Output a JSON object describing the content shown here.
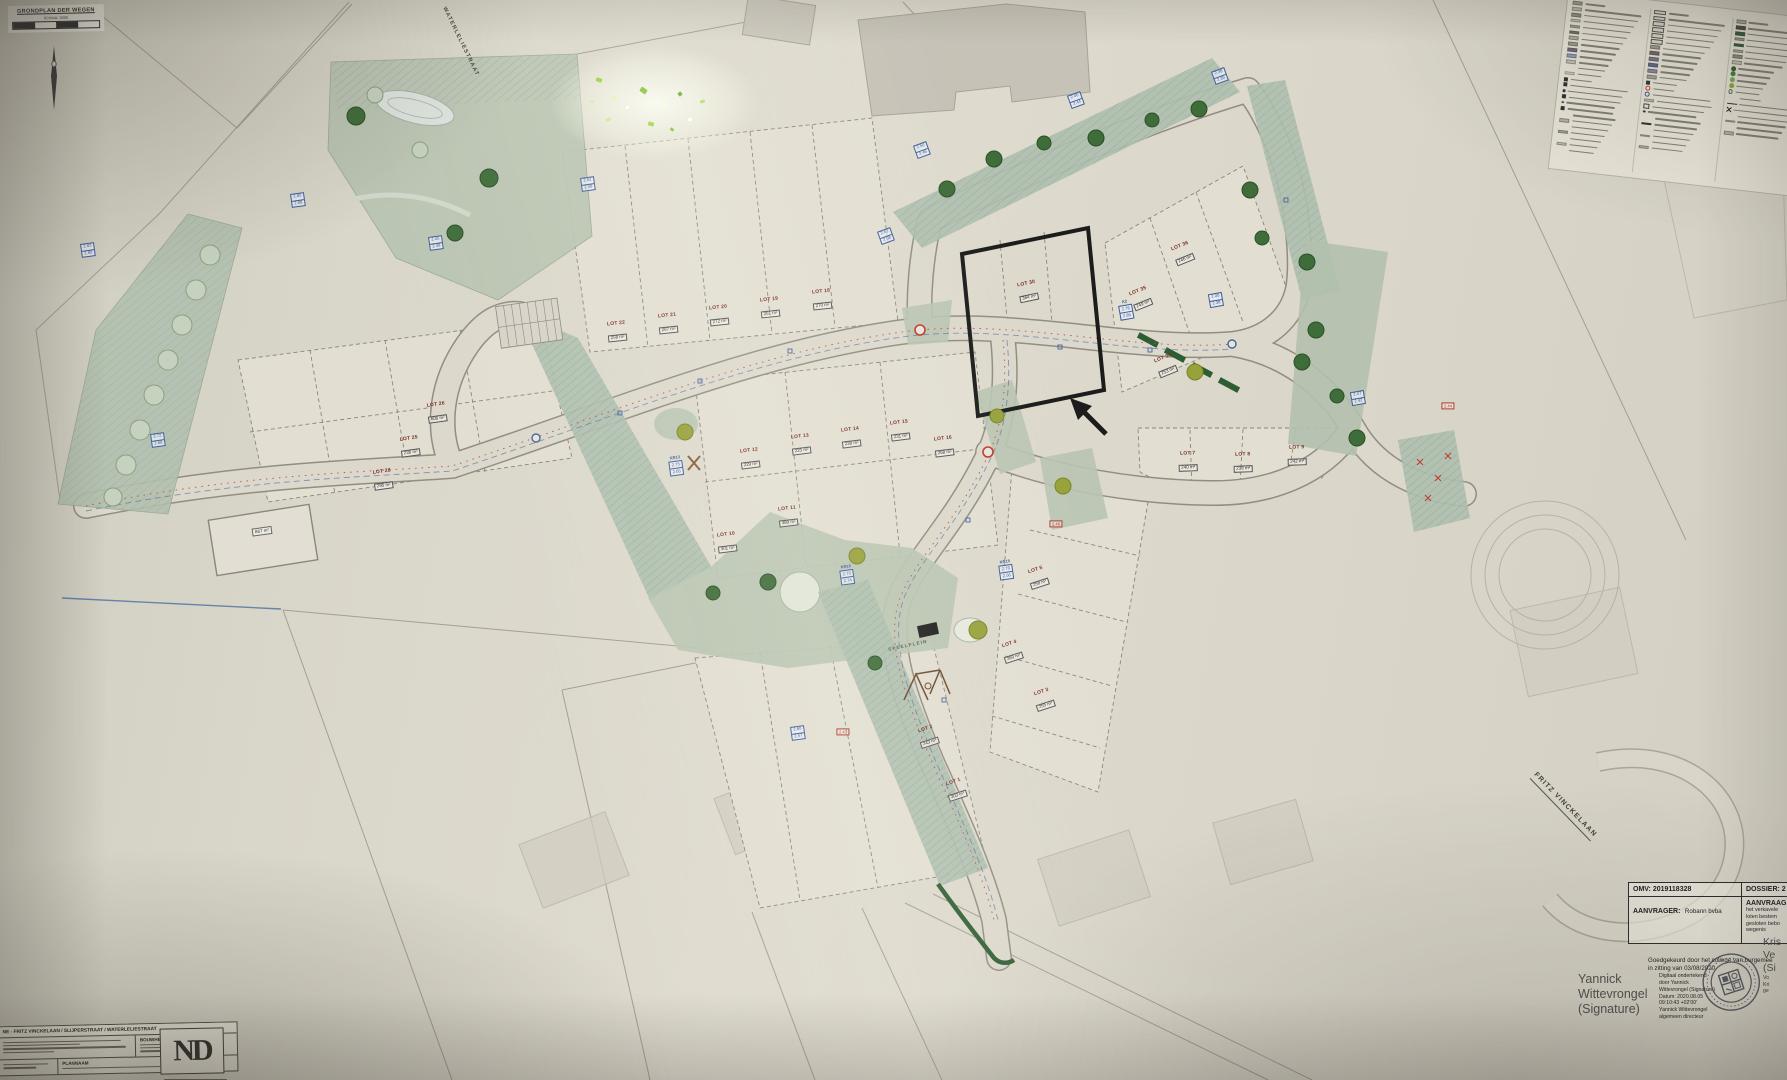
{
  "colors": {
    "paper": "#d9d6ca",
    "green": "#b9c4b1",
    "road_edge": "#918d82",
    "accent_red": "#b5493c",
    "accent_blue": "#48639c",
    "legend_green": "#2e5d33"
  },
  "title_box": {
    "title": "GRONDPLAN DER WEGEN",
    "scale": "SCHAAL 1/500"
  },
  "street_labels": [
    {
      "text": "WATERLELIESTRAAT",
      "x": 460,
      "y": 42,
      "angle": 64,
      "size": 5.5,
      "c": "#3f3f39",
      "u": false
    },
    {
      "text": "FRITZ VINCKELAAN",
      "x": 1564,
      "y": 806,
      "angle": 46,
      "size": 7,
      "c": "#3f3f39",
      "u": true
    },
    {
      "text": "SPEELPLEIN",
      "x": 908,
      "y": 646,
      "angle": -12,
      "size": 4.5,
      "c": "#4e5c48",
      "u": false
    }
  ],
  "lot_labels": [
    {
      "name": "LOT 18",
      "area": "270 m²",
      "x": 822,
      "y": 300,
      "angle": -6
    },
    {
      "name": "LOT 19",
      "area": "261 m²",
      "x": 770,
      "y": 308,
      "angle": -6
    },
    {
      "name": "LOT 20",
      "area": "272 m²",
      "x": 719,
      "y": 316,
      "angle": -6
    },
    {
      "name": "LOT 21",
      "area": "267 m²",
      "x": 668,
      "y": 324,
      "angle": -6
    },
    {
      "name": "LOT 22",
      "area": "258 m²",
      "x": 617,
      "y": 332,
      "angle": -6
    },
    {
      "name": "LOT 26",
      "area": "606 m²",
      "x": 437,
      "y": 413,
      "angle": -8
    },
    {
      "name": "LOT 25",
      "area": "236 m²",
      "x": 410,
      "y": 447,
      "angle": -8
    },
    {
      "name": "LOT 28",
      "area": "295 m²",
      "x": 383,
      "y": 480,
      "angle": -8
    },
    {
      "name": "LOT 10",
      "area": "301 m²",
      "x": 727,
      "y": 543,
      "angle": -7
    },
    {
      "name": "LOT 11",
      "area": "389 m²",
      "x": 788,
      "y": 517,
      "angle": -7
    },
    {
      "name": "LOT 12",
      "area": "229 m²",
      "x": 750,
      "y": 459,
      "angle": -7
    },
    {
      "name": "LOT 13",
      "area": "225 m²",
      "x": 801,
      "y": 445,
      "angle": -7
    },
    {
      "name": "LOT 14",
      "area": "228 m²",
      "x": 851,
      "y": 438,
      "angle": -7
    },
    {
      "name": "LOT 15",
      "area": "231 m²",
      "x": 900,
      "y": 431,
      "angle": -7
    },
    {
      "name": "LOT 16",
      "area": "268 m²",
      "x": 944,
      "y": 447,
      "angle": -7
    },
    {
      "name": "LOT 30",
      "area": "364 m²",
      "x": 1028,
      "y": 292,
      "angle": -12
    },
    {
      "name": "LOT 34",
      "area": "253 m²",
      "x": 1166,
      "y": 366,
      "angle": -22
    },
    {
      "name": "LOT 35",
      "area": "249 m²",
      "x": 1141,
      "y": 299,
      "angle": -22
    },
    {
      "name": "LOT 36",
      "area": "246 m²",
      "x": 1183,
      "y": 254,
      "angle": -22
    },
    {
      "name": "LOT 7",
      "area": "240 m²",
      "x": 1188,
      "y": 462,
      "angle": -2
    },
    {
      "name": "LOT 8",
      "area": "238 m²",
      "x": 1243,
      "y": 463,
      "angle": -2
    },
    {
      "name": "LOT 9",
      "area": "242 m²",
      "x": 1297,
      "y": 456,
      "angle": -2
    },
    {
      "name": "LOT 5",
      "area": "258 m²",
      "x": 1038,
      "y": 578,
      "angle": -18
    },
    {
      "name": "LOT 4",
      "area": "260 m²",
      "x": 1012,
      "y": 652,
      "angle": -18
    },
    {
      "name": "LOT 3",
      "area": "255 m²",
      "x": 1044,
      "y": 700,
      "angle": -18
    },
    {
      "name": "LOT 2",
      "area": "243 m²",
      "x": 928,
      "y": 737,
      "angle": -18
    },
    {
      "name": "LOT 1",
      "area": "303 m²",
      "x": 956,
      "y": 790,
      "angle": -18
    }
  ],
  "elevation_labels": [
    {
      "k": "",
      "a": "2.45",
      "b": "2.48",
      "x": 436,
      "y": 243,
      "angle": -8
    },
    {
      "k": "",
      "a": "2.85",
      "b": "2.88",
      "x": 298,
      "y": 200,
      "angle": -8
    },
    {
      "k": "",
      "a": "2.83",
      "b": "2.80",
      "x": 88,
      "y": 250,
      "angle": -8
    },
    {
      "k": "",
      "a": "2.52",
      "b": "2.49",
      "x": 588,
      "y": 184,
      "angle": -8
    },
    {
      "k": "",
      "a": "2.50",
      "b": "2.46",
      "x": 922,
      "y": 150,
      "angle": -20
    },
    {
      "k": "",
      "a": "2.62",
      "b": "2.58",
      "x": 886,
      "y": 236,
      "angle": -20
    },
    {
      "k": "",
      "a": "2.46",
      "b": "2.44",
      "x": 1076,
      "y": 100,
      "angle": -20
    },
    {
      "k": "",
      "a": "2.38",
      "b": "2.35",
      "x": 1220,
      "y": 76,
      "angle": -20
    },
    {
      "k": "K2",
      "a": "2.79",
      "b": "2.85",
      "x": 1126,
      "y": 310,
      "angle": -10
    },
    {
      "k": "",
      "a": "2.30",
      "b": "2.38",
      "x": 1216,
      "y": 300,
      "angle": -10
    },
    {
      "k": "",
      "a": "2.47",
      "b": "2.42",
      "x": 1358,
      "y": 398,
      "angle": -10
    },
    {
      "k": "KR13",
      "a": "2.75",
      "b": "2.65",
      "x": 676,
      "y": 466,
      "angle": -8
    },
    {
      "k": "KR16",
      "a": "2.70",
      "b": "2.74",
      "x": 847,
      "y": 575,
      "angle": -8
    },
    {
      "k": "KR15",
      "a": "2.76",
      "b": "2.56",
      "x": 1006,
      "y": 570,
      "angle": -8
    },
    {
      "k": "",
      "a": "2.72",
      "b": "2.68",
      "x": 158,
      "y": 440,
      "angle": -8
    },
    {
      "k": "",
      "a": "2.60",
      "b": "2.57",
      "x": 798,
      "y": 733,
      "angle": -8
    }
  ],
  "red_labels": [
    {
      "t": "2.44",
      "x": 1448,
      "y": 406
    },
    {
      "t": "2.43",
      "x": 843,
      "y": 732
    },
    {
      "t": "2.46",
      "x": 1056,
      "y": 524
    }
  ],
  "area_labels": [
    {
      "t": "867 m²",
      "x": 262,
      "y": 531,
      "angle": -8
    }
  ],
  "legend": {
    "columns": [
      {
        "items": [
          {
            "t": "rect",
            "c": "#9d9a8e"
          },
          {
            "t": "rect",
            "c": "#b8b5a9"
          },
          {
            "t": "rect",
            "c": "#8e8b80"
          },
          {
            "t": "rect",
            "c": "#c7c4b8"
          },
          {
            "t": "rect",
            "c": "#a8a599"
          },
          {
            "t": "rect",
            "c": "#757268"
          },
          {
            "t": "rect",
            "c": "#b0ad9f"
          },
          {
            "t": "rect",
            "c": "#9d9a8e"
          },
          {
            "t": "rect",
            "c": "#6b6880"
          },
          {
            "t": "rect",
            "c": "#8f9bb5"
          },
          {
            "t": "rect",
            "c": "#c3c0b4"
          },
          {
            "t": "none"
          },
          {
            "t": "rect",
            "c": "#d8d5c9"
          },
          {
            "t": "icon",
            "c": "#2e2e2e"
          },
          {
            "t": "icon",
            "c": "#2e2e2e"
          },
          {
            "t": "dot",
            "c": "#2e2e2e"
          },
          {
            "t": "icon",
            "c": "#2e2e2e"
          },
          {
            "t": "dot",
            "c": "#555555"
          },
          {
            "t": "icon",
            "c": "#2e2e2e"
          },
          {
            "t": "none"
          },
          {
            "t": "rect",
            "c": "#b5b2a6"
          },
          {
            "t": "none"
          },
          {
            "t": "rect",
            "c": "#a8a599"
          },
          {
            "t": "none"
          },
          {
            "t": "rect",
            "c": "#c0bdb1"
          },
          {
            "t": "none"
          }
        ]
      },
      {
        "items": [
          {
            "t": "box"
          },
          {
            "t": "box"
          },
          {
            "t": "box"
          },
          {
            "t": "box"
          },
          {
            "t": "box"
          },
          {
            "t": "box"
          },
          {
            "t": "rect",
            "c": "#9d9a8e"
          },
          {
            "t": "rect",
            "c": "#6d6a60"
          },
          {
            "t": "rect",
            "c": "#7a7790"
          },
          {
            "t": "rect",
            "c": "#5a6b8c"
          },
          {
            "t": "rect",
            "c": "#8b88a0"
          },
          {
            "t": "rect",
            "c": "#a8a599"
          },
          {
            "t": "icon",
            "c": "#333333"
          },
          {
            "t": "ring",
            "c": "#c0392b"
          },
          {
            "t": "ring",
            "c": "#34558b"
          },
          {
            "t": "rect",
            "c": "#c3c0b4"
          },
          {
            "t": "bldg"
          },
          {
            "t": "dot",
            "c": "#333333"
          },
          {
            "t": "none"
          },
          {
            "t": "bar",
            "c": "#2e2e2e"
          },
          {
            "t": "none"
          },
          {
            "t": "bar",
            "c": "#8a8778"
          },
          {
            "t": "none"
          },
          {
            "t": "rect",
            "c": "#b5b2a6"
          }
        ]
      },
      {
        "items": [
          {
            "t": "rect",
            "c": "#a8a599"
          },
          {
            "t": "rect",
            "c": "#454545"
          },
          {
            "t": "rect",
            "c": "#2e5d33"
          },
          {
            "t": "rect",
            "c": "#9d9a8e"
          },
          {
            "t": "rect",
            "c": "#2e5d33"
          },
          {
            "t": "rect",
            "c": "#b0ad9f"
          },
          {
            "t": "rect",
            "c": "#8e8b80"
          },
          {
            "t": "rect",
            "c": "#c3c0b4"
          },
          {
            "t": "circle",
            "c": "#2e5d33"
          },
          {
            "t": "circle",
            "c": "#3f7d3c"
          },
          {
            "t": "circle",
            "c": "#6fae5c"
          },
          {
            "t": "circle",
            "c": "#93a13a"
          },
          {
            "t": "ringc",
            "c": "#557a4e"
          },
          {
            "t": "none"
          },
          {
            "t": "bar",
            "c": "#2e2e2e"
          },
          {
            "t": "x"
          },
          {
            "t": "none"
          },
          {
            "t": "bar",
            "c": "#8a8778"
          },
          {
            "t": "none"
          },
          {
            "t": "rect",
            "c": "#b5b2a6"
          }
        ]
      }
    ]
  },
  "approval": {
    "omv": "OMV: 2019118328",
    "dossier": "DOSSIER:  2",
    "aanvrager_label": "AANVRAGER:",
    "aanvrager_value": "Robann bvba",
    "aanvraag_label": "AANVRAAG:",
    "aanvraag_lines": [
      "het verkavele",
      "loten bestem",
      "gesloten bebo",
      "wegenis"
    ],
    "approved_line1": "Goedgekeurd door het college van burgemee",
    "approved_line2": "in zitting van   03/08/2020",
    "sig_line1": "Yannick",
    "sig_line2": "Wittevrongel",
    "sig_line3": "(Signature)",
    "sig_details": [
      "Digitaal ondertekend",
      "door Yannick",
      "Wittevrongel (Signature)",
      "Datum: 2020.08.05",
      "09:10:43 +02'00'",
      "Yannick Wittevrongel",
      "algemeen directeur"
    ],
    "edge_fragments": [
      "Kris",
      "Ve",
      "(Si",
      "Vo",
      "Kri",
      "ge"
    ]
  },
  "titleblock": {
    "header": "NE - FRITZ VINCKELAAN / SLIJPERSTRAAT / WATERLELIESTRAAT",
    "bouwheer_label": "BOUWHEER",
    "plannaam_label": "PLANNAAM",
    "logo": "ND"
  }
}
